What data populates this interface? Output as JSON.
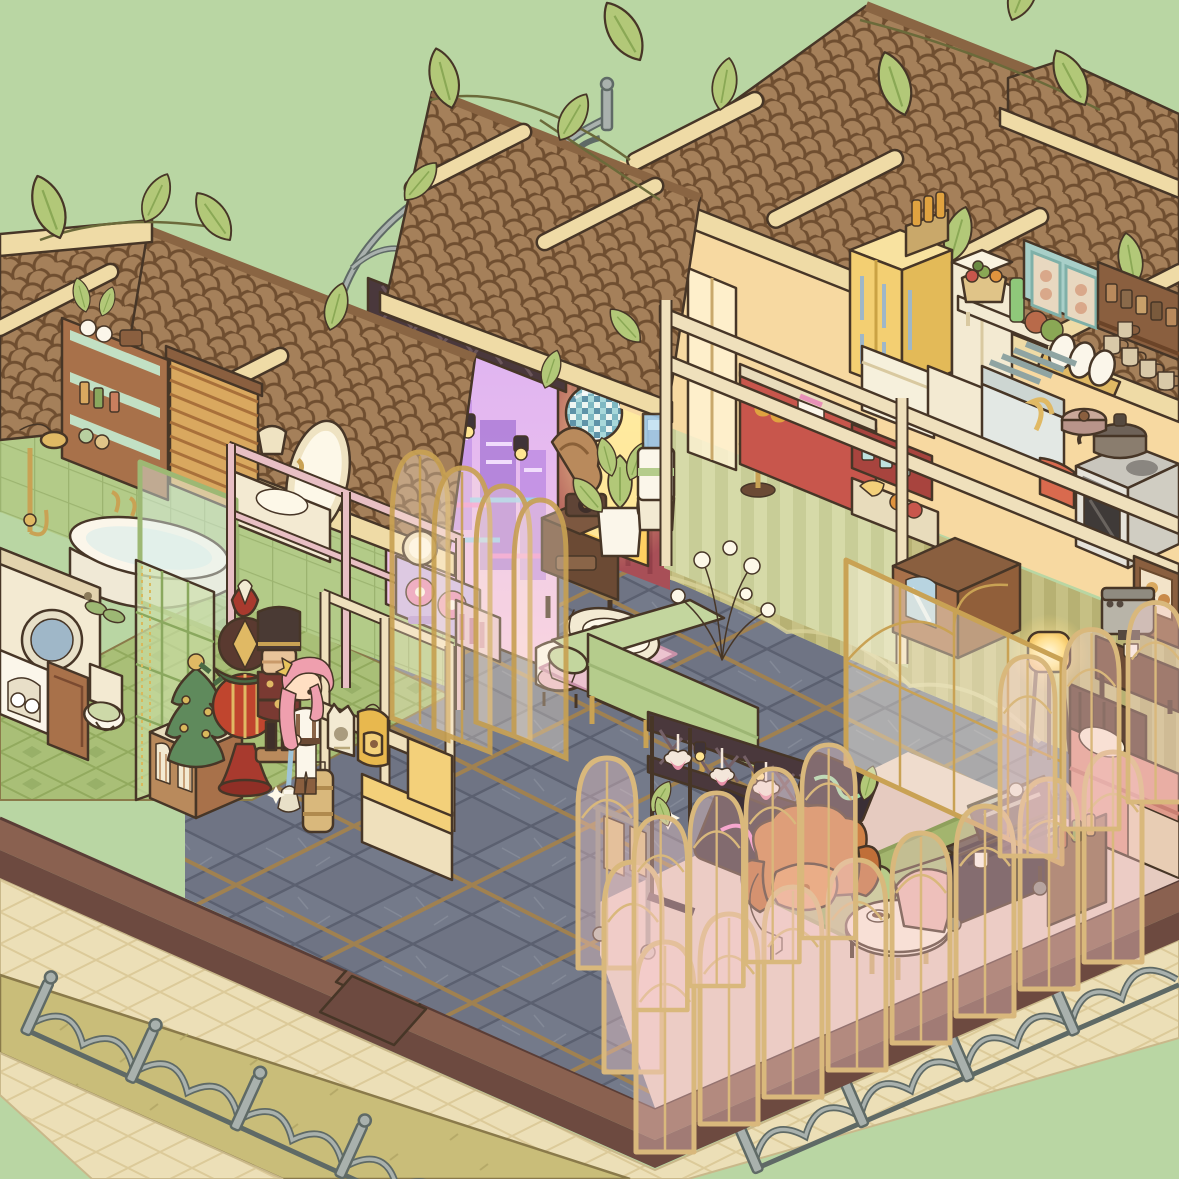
{
  "meta": {
    "scene": "isometric-cutaway-house",
    "style": "cozy-cartoon-decoration-game",
    "canvas_px": {
      "width": 1179,
      "height": 1179
    },
    "visible_text": "none",
    "season_decor": [
      "christmas-garland",
      "christmas-tree",
      "nutcracker",
      "ornament-tower"
    ]
  },
  "palette": {
    "bg": "#b9d6a3",
    "lawn": "#c9bd79",
    "lawnLine": "#b1a565",
    "walk": "#ecdfb7",
    "walkLine": "#d9c795",
    "baseTop": "#8a6150",
    "baseFace": "#6d4a40",
    "baseDark": "#5a3d36",
    "slate": "#6f7484",
    "slateLine": "#5b6070",
    "gold": "#b8904f",
    "bathFloor": "#a9bf77",
    "kWall": "#f7d9a1",
    "kWallGlow": "#ffeebc",
    "greenTile": "#b3cb88",
    "maroon": "#a84f57",
    "neonTop": "#ddb2f2",
    "neonBot": "#f6c8e4",
    "roof": "#a5805a",
    "roofLine": "#6f4e30",
    "ridge": "#8a6543",
    "beam": "#efdba6",
    "leaf": "#b2c878",
    "leafDark": "#92ac57",
    "fence": "#a9b1ad",
    "fenceLine": "#5f6a66",
    "glassGold": "#c9a254",
    "tanFrame": "#d9b87c",
    "wood": "#a8714a",
    "woodDark": "#7a4a30",
    "walnut": "#6b4a34",
    "cream": "#f3ead2",
    "creamDark": "#e3d3ae",
    "fridge": "#f3cf72",
    "teal": "#a8cfc8",
    "stove": "#e6e3da",
    "sofa": "#b5cc8c",
    "sofaDark": "#9db674",
    "bedPink": "#e09b8b",
    "chair": "#cf8146",
    "chairSeat": "#e29a5c",
    "chaise": "#a9bd7c",
    "red": "#c8564c",
    "hair": "#ef9fae",
    "skin": "#ffdfc2",
    "white": "#fbf6ea",
    "disco1": "#a8d8da",
    "disco2": "#5f93a8",
    "glow": "#ffda7a",
    "outline": "#473627"
  },
  "outdoor": {
    "ground": [
      "grass-lawn",
      "cream-tile-walkway",
      "porch-steps-x3",
      "foundation-platform"
    ],
    "fences": [
      "scroll-fence-bottom-left",
      "scroll-fence-bottom-right",
      "background-fence-segments"
    ]
  },
  "rooms": [
    {
      "id": "bathroom",
      "label": "Bathroom",
      "items": [
        "green-tile-wall",
        "garland-lights",
        "toiletry-shelf",
        "shelf-plant",
        "wood-blinds-window",
        "wall-lamp",
        "oval-mirror",
        "vanity-sink",
        "pink-railing",
        "gold-shower-set",
        "bathtub",
        "glass-tub-screen",
        "washing-machine",
        "towel-cabinet",
        "wood-cabinet",
        "toilet",
        "green-slippers",
        "folding-screen-door",
        "green-pattern-floor"
      ]
    },
    {
      "id": "entryway",
      "label": "Entryway",
      "items": [
        "display-cabinet",
        "christmas-tree",
        "ornament-tower",
        "nutcracker",
        "partition-shelf",
        "cat-tote-bag",
        "yellow-backpack",
        "entry-bench",
        "suitcase",
        "slate-gold-floor"
      ]
    },
    {
      "id": "music-nook",
      "label": "Music nook",
      "items": [
        "neon-city-wall",
        "lighting-truss",
        "spotlights",
        "disco-ball",
        "gramophone",
        "gramophone-table",
        "potted-pothos",
        "water-cooler",
        "dj-sideboard",
        "round-vanity-mirror",
        "cushion-chair",
        "gold-arch-screens",
        "arch-doorway-glow"
      ]
    },
    {
      "id": "lounge",
      "label": "Center lounge",
      "items": [
        "green-sofa",
        "baby-cradle",
        "pink-rug",
        "branch-orb-lamp"
      ]
    },
    {
      "id": "kitchen",
      "label": "Kitchen & bar",
      "items": [
        "refrigerator",
        "bottle-crate",
        "pantry-cabinet",
        "vegetable-shelf",
        "teal-wall-cabinet",
        "spice-shelf",
        "hanging-mugs",
        "dish-rack",
        "dishwasher",
        "counter-cabinet",
        "drying-rail-counter",
        "cooktop-pan",
        "pressure-cooker",
        "oven",
        "red-towel",
        "red-bar-counter",
        "bar-stool",
        "glass-display-shelf",
        "fruit-cart",
        "balcony-door",
        "corridor-rails",
        "striped-wallpaper"
      ]
    },
    {
      "id": "bedroom",
      "label": "Bedroom corner",
      "items": [
        "mirror-wardrobe",
        "glowing-floor-lamp",
        "coffee-machine-stand",
        "pastry-display-case",
        "double-bed",
        "gold-glass-partition"
      ]
    },
    {
      "id": "conservatory",
      "label": "Glass conservatory",
      "items": [
        "glass-arch-fence",
        "stage-truss",
        "strawberry-garland",
        "neon-sign-boards",
        "towel-rack",
        "hanging-plants",
        "orange-armchair",
        "throw-blanket",
        "round-coffee-table",
        "coffee-cup",
        "pink-chair",
        "green-chaise",
        "area-rug",
        "bbq-grill-station",
        "bottle-side-table"
      ]
    },
    {
      "id": "roofline",
      "label": "Roofs",
      "items": [
        "shingle-roof-left",
        "shingle-roof-middle",
        "shingle-roof-right",
        "gable-roof-small",
        "cream-fascia-beams",
        "rafter-beams",
        "vine-leaves"
      ]
    }
  ],
  "character": {
    "id": "resident",
    "hair_color_name": "pink",
    "outfit": "white-with-brown-vest",
    "holding": "broom",
    "location": "entryway"
  }
}
